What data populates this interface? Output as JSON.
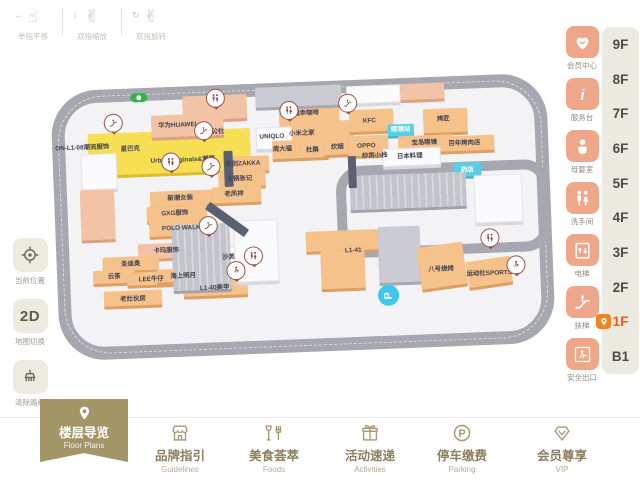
{
  "colors": {
    "accent_olive": "#a39566",
    "service_salmon": "#efa78b",
    "floor_active_orange": "#f25d12",
    "road_gray": "#a7a7b1",
    "block_orange": "#f6c28b",
    "block_yellow": "#f6df52",
    "block_cyan": "#57cfe7",
    "rail_beige": "#ece9e0"
  },
  "gesture_hints": [
    {
      "icon": "pan-gesture-icon",
      "label": "单指平移",
      "hand": "☝",
      "mod": "↔"
    },
    {
      "icon": "pinch-zoom-gesture-icon",
      "label": "双指缩放",
      "hand": "✌",
      "mod": "↕"
    },
    {
      "icon": "rotate-gesture-icon",
      "label": "双指旋转",
      "hand": "✌",
      "mod": "↻"
    }
  ],
  "left_tools": [
    {
      "icon": "current-location-icon",
      "label": "当前位置"
    },
    {
      "icon": "map-2d-toggle",
      "label": "地图切换",
      "text": "2D"
    },
    {
      "icon": "clear-route-icon",
      "label": "清除路线"
    }
  ],
  "services": [
    {
      "icon": "member-center-icon",
      "label": "会员中心"
    },
    {
      "icon": "info-desk-icon",
      "label": "服务台"
    },
    {
      "icon": "baby-room-icon",
      "label": "母婴室"
    },
    {
      "icon": "restroom-icon",
      "label": "洗手间"
    },
    {
      "icon": "elevator-icon",
      "label": "电梯"
    },
    {
      "icon": "escalator-icon",
      "label": "扶梯"
    },
    {
      "icon": "safety-exit-icon",
      "label": "安全出口"
    }
  ],
  "floor_rail": {
    "items": [
      "9F",
      "8F",
      "7F",
      "6F",
      "5F",
      "4F",
      "3F",
      "2F",
      "1F",
      "B1"
    ],
    "active": "1F"
  },
  "bottom_nav": [
    {
      "icon": "map-pin-icon",
      "label": "楼层导览",
      "sublabel": "Floor Plans",
      "active": true
    },
    {
      "icon": "storefront-icon",
      "label": "品牌指引",
      "sublabel": "Guidelines",
      "active": false
    },
    {
      "icon": "dining-icon",
      "label": "美食荟萃",
      "sublabel": "Foods",
      "active": false
    },
    {
      "icon": "gift-icon",
      "label": "活动速递",
      "sublabel": "Activities",
      "active": false
    },
    {
      "icon": "parking-icon",
      "label": "停车缴费",
      "sublabel": "Parking",
      "active": false
    },
    {
      "icon": "vip-diamond-icon",
      "label": "会员尊享",
      "sublabel": "VIP",
      "active": false
    }
  ],
  "map": {
    "entrance_badge": {
      "x": 80,
      "y": 5
    },
    "metro_badge": {
      "x": 320,
      "y": 206,
      "letter": "P"
    },
    "blocks": [
      {
        "x": 36,
        "y": 44,
        "w": 162,
        "h": 42,
        "c": "ye"
      },
      {
        "x": 132,
        "y": 10,
        "w": 64,
        "h": 24,
        "c": "sa"
      },
      {
        "x": 228,
        "y": 18,
        "w": 60,
        "h": 26,
        "c": "or"
      },
      {
        "x": 100,
        "y": 28,
        "w": 72,
        "h": 22,
        "c": "sa"
      },
      {
        "x": 204,
        "y": 44,
        "w": 42,
        "h": 20,
        "c": "wh"
      },
      {
        "x": 240,
        "y": 40,
        "w": 62,
        "h": 22,
        "c": "or"
      },
      {
        "x": 220,
        "y": 58,
        "w": 46,
        "h": 18,
        "c": "or"
      },
      {
        "x": 248,
        "y": 60,
        "w": 28,
        "h": 16,
        "c": "or"
      },
      {
        "x": 272,
        "y": 58,
        "w": 30,
        "h": 16,
        "c": "or"
      },
      {
        "x": 296,
        "y": 56,
        "w": 40,
        "h": 20,
        "c": "or"
      },
      {
        "x": 298,
        "y": 30,
        "w": 44,
        "h": 22,
        "c": "or"
      },
      {
        "x": 372,
        "y": 32,
        "w": 44,
        "h": 24,
        "c": "or"
      },
      {
        "x": 336,
        "y": 46,
        "w": 26,
        "h": 12,
        "c": "cy"
      },
      {
        "x": 346,
        "y": 58,
        "w": 54,
        "h": 15,
        "c": "or"
      },
      {
        "x": 384,
        "y": 60,
        "w": 58,
        "h": 15,
        "c": "or"
      },
      {
        "x": 330,
        "y": 70,
        "w": 56,
        "h": 16,
        "c": "wh"
      },
      {
        "x": 400,
        "y": 87,
        "w": 28,
        "h": 14,
        "c": "cy"
      },
      {
        "x": 420,
        "y": 100,
        "w": 46,
        "h": 46,
        "c": "wh"
      },
      {
        "x": 170,
        "y": 72,
        "w": 46,
        "h": 15,
        "c": "or"
      },
      {
        "x": 165,
        "y": 87,
        "w": 47,
        "h": 15,
        "c": "or"
      },
      {
        "x": 158,
        "y": 102,
        "w": 49,
        "h": 16,
        "c": "or"
      },
      {
        "x": 96,
        "y": 104,
        "w": 62,
        "h": 15,
        "c": "or"
      },
      {
        "x": 92,
        "y": 119,
        "w": 60,
        "h": 15,
        "c": "or"
      },
      {
        "x": 94,
        "y": 134,
        "w": 66,
        "h": 15,
        "c": "or"
      },
      {
        "x": 82,
        "y": 156,
        "w": 58,
        "h": 15,
        "c": "sa"
      },
      {
        "x": 46,
        "y": 168,
        "w": 56,
        "h": 14,
        "c": "or"
      },
      {
        "x": 36,
        "y": 181,
        "w": 42,
        "h": 13,
        "c": "or"
      },
      {
        "x": 70,
        "y": 184,
        "w": 48,
        "h": 13,
        "c": "or"
      },
      {
        "x": 100,
        "y": 182,
        "w": 52,
        "h": 13,
        "c": "or"
      },
      {
        "x": 148,
        "y": 162,
        "w": 52,
        "h": 22,
        "c": "wh"
      },
      {
        "x": 126,
        "y": 195,
        "w": 64,
        "h": 15,
        "c": "or"
      },
      {
        "x": 46,
        "y": 202,
        "w": 58,
        "h": 15,
        "c": "or"
      },
      {
        "x": 116,
        "y": 138,
        "w": 58,
        "h": 66,
        "c": "rib"
      },
      {
        "x": 178,
        "y": 136,
        "w": 42,
        "h": 60,
        "c": "wh"
      },
      {
        "x": 250,
        "y": 150,
        "w": 72,
        "h": 20,
        "c": "or"
      },
      {
        "x": 264,
        "y": 170,
        "w": 44,
        "h": 38,
        "c": "or"
      },
      {
        "x": 322,
        "y": 148,
        "w": 42,
        "h": 56,
        "c": "gy"
      },
      {
        "x": 362,
        "y": 168,
        "w": 46,
        "h": 42,
        "c": "or",
        "r": -6
      },
      {
        "x": 410,
        "y": 184,
        "w": 44,
        "h": 26,
        "c": "or",
        "r": -6
      },
      {
        "x": 296,
        "y": 96,
        "w": 116,
        "h": 34,
        "c": "rib"
      },
      {
        "x": 205,
        "y": 4,
        "w": 86,
        "h": 20,
        "c": "gy"
      },
      {
        "x": 296,
        "y": 6,
        "w": 52,
        "h": 16,
        "c": "wh"
      },
      {
        "x": 350,
        "y": 6,
        "w": 44,
        "h": 16,
        "c": "sa"
      },
      {
        "x": 28,
        "y": 64,
        "w": 34,
        "h": 34,
        "c": "wh"
      },
      {
        "x": 26,
        "y": 100,
        "w": 34,
        "h": 50,
        "c": "sa"
      },
      {
        "x": 171,
        "y": 66,
        "w": 9,
        "h": 36,
        "c": "dk"
      },
      {
        "x": 148,
        "y": 130,
        "w": 48,
        "h": 9,
        "c": "dk",
        "r": 38
      },
      {
        "x": 295,
        "y": 76,
        "w": 8,
        "h": 32,
        "c": "dk"
      }
    ],
    "inner_road": {
      "x": 282,
      "y": 86,
      "w": 214,
      "h": 92
    },
    "labels": [
      {
        "x": 78,
        "y": 60,
        "t": "星巴克"
      },
      {
        "x": 130,
        "y": 73,
        "t": "Urban originals&潮牌"
      },
      {
        "x": 30,
        "y": 57,
        "t": "ON-L1-08潮流服饰"
      },
      {
        "x": 255,
        "y": 31,
        "t": "瑞幸咖啡"
      },
      {
        "x": 250,
        "y": 51,
        "t": "小米之家"
      },
      {
        "x": 220,
        "y": 53,
        "t": "UNIQLO"
      },
      {
        "x": 230,
        "y": 66,
        "t": "周大福"
      },
      {
        "x": 260,
        "y": 68,
        "t": "杜鹃"
      },
      {
        "x": 285,
        "y": 66,
        "t": "炊烟"
      },
      {
        "x": 314,
        "y": 66,
        "t": "OPPO"
      },
      {
        "x": 318,
        "y": 41,
        "t": "KFC"
      },
      {
        "x": 126,
        "y": 38,
        "t": "华为HUAWEI"
      },
      {
        "x": 163,
        "y": 46,
        "t": "尚公社"
      },
      {
        "x": 190,
        "y": 79,
        "t": "名创ZAKKA"
      },
      {
        "x": 186,
        "y": 94,
        "t": "火锅张记"
      },
      {
        "x": 180,
        "y": 109,
        "t": "老凤祥"
      },
      {
        "x": 322,
        "y": 76,
        "t": "炒货小栈"
      },
      {
        "x": 392,
        "y": 42,
        "t": "烤匠"
      },
      {
        "x": 349,
        "y": 51,
        "t": "眼镜站",
        "w": true
      },
      {
        "x": 372,
        "y": 65,
        "t": "宝岛眼镜"
      },
      {
        "x": 412,
        "y": 67,
        "t": "百年烤肉店"
      },
      {
        "x": 357,
        "y": 78,
        "t": "日本料理"
      },
      {
        "x": 414,
        "y": 94,
        "t": "药店",
        "w": true
      },
      {
        "x": 126,
        "y": 111,
        "t": "新潮女装"
      },
      {
        "x": 120,
        "y": 126,
        "t": "GXG服饰"
      },
      {
        "x": 126,
        "y": 141,
        "t": "POLO WALK"
      },
      {
        "x": 110,
        "y": 163,
        "t": "卡玛服饰"
      },
      {
        "x": 74,
        "y": 175,
        "t": "圣迪奥"
      },
      {
        "x": 57,
        "y": 187,
        "t": "云茶"
      },
      {
        "x": 94,
        "y": 191,
        "t": "LEE牛仔"
      },
      {
        "x": 126,
        "y": 189,
        "t": "海上明月"
      },
      {
        "x": 172,
        "y": 172,
        "t": "沙芙"
      },
      {
        "x": 157,
        "y": 202,
        "t": "L1-40美甲"
      },
      {
        "x": 75,
        "y": 210,
        "t": "老灶伙房"
      },
      {
        "x": 297,
        "y": 170,
        "t": "L1-41"
      },
      {
        "x": 384,
        "y": 192,
        "t": "八号烧烤"
      },
      {
        "x": 432,
        "y": 198,
        "t": "运动社SPORTS"
      }
    ],
    "pins": [
      {
        "type": "restroom",
        "x": 165,
        "y": 13
      },
      {
        "type": "escalator",
        "x": 62,
        "y": 34
      },
      {
        "type": "escalator",
        "x": 152,
        "y": 45
      },
      {
        "type": "restroom",
        "x": 238,
        "y": 28
      },
      {
        "type": "escalator",
        "x": 297,
        "y": 23
      },
      {
        "type": "restroom",
        "x": 118,
        "y": 75
      },
      {
        "type": "escalator",
        "x": 158,
        "y": 81
      },
      {
        "type": "escalator",
        "x": 153,
        "y": 140
      },
      {
        "type": "restroom",
        "x": 197,
        "y": 172
      },
      {
        "type": "exit",
        "x": 179,
        "y": 186
      },
      {
        "type": "restroom",
        "x": 434,
        "y": 163
      },
      {
        "type": "exit",
        "x": 459,
        "y": 191
      }
    ]
  }
}
